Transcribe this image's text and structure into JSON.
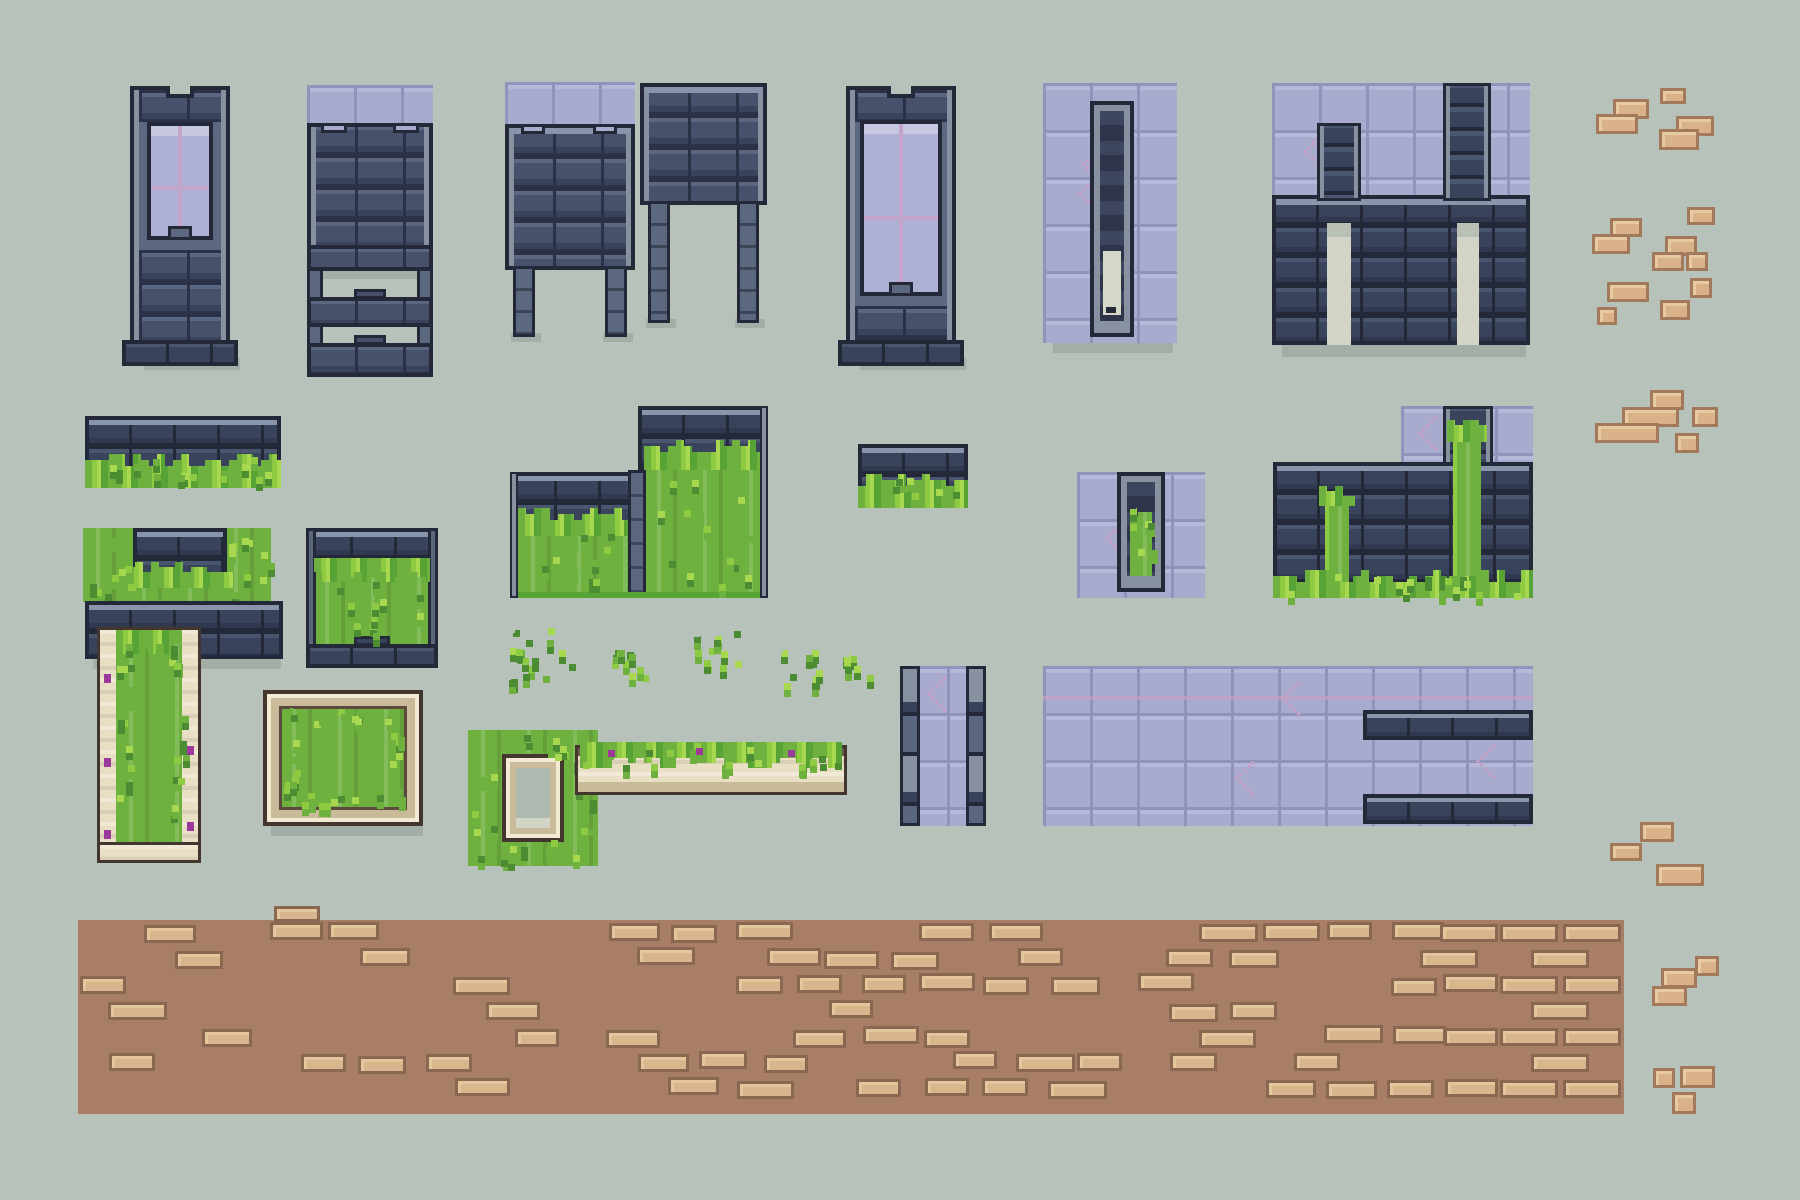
{
  "palette": {
    "bg": "#b7c3ba",
    "shadow": "#a3afa6",
    "outline": "#232938",
    "mortar": "#2b3247",
    "stoneFace": "#47516c",
    "stoneHi": "#5b6681",
    "stoneLow": "#3a435c",
    "trim": "#8995ab",
    "railLight": "#87919f",
    "purple": "#a9abce",
    "purpleLine": "#9093ba",
    "purpleHi": "#b6b8d9",
    "crack": "#c79ec3",
    "glass": "#aeb1d4",
    "glassHi": "#c5c8e6",
    "mullion": "#c2a5c8",
    "grass": "#6fb13f",
    "grassHi": "#a8d84f",
    "grassMid": "#8fcb42",
    "grassDark": "#4c8c33",
    "grassLine": "#57a336",
    "cream": "#e9dfc4",
    "creamHi": "#f2ead2",
    "creamLow": "#c9bb9a",
    "creamEdge": "#43362f",
    "brickFace": "#d9b28a",
    "brickHi": "#e7c9a2",
    "brickLine": "#a3795b",
    "pathBase": "#a87f66",
    "pathBrick": "#d8b58c",
    "pathBrickHi": "#e5c69c",
    "pathBrickLine": "#8a6750",
    "creamHole": "#d6d8c8",
    "doorGap": "#d2d4c6",
    "flower": "#9c3a9c"
  },
  "canvas": {
    "w": 1800,
    "h": 1200
  },
  "pieces": [
    {
      "id": "tower-window",
      "kind": "tower",
      "x": 130,
      "y": 86,
      "w": 100,
      "h": 280,
      "win": [
        17,
        36,
        66,
        118
      ]
    },
    {
      "id": "gate-frame",
      "kind": "gate",
      "x": 307,
      "y": 85,
      "w": 126,
      "h": 292
    },
    {
      "id": "wall-on-legs-left",
      "kind": "wallLegs",
      "x": 505,
      "y": 82,
      "w": 130,
      "h": 255,
      "purpleTop": true,
      "wallTop": 42,
      "wallH": 146,
      "legH": 67
    },
    {
      "id": "wall-on-legs-right",
      "kind": "wallLegs",
      "x": 640,
      "y": 83,
      "w": 127,
      "h": 240,
      "purpleTop": false,
      "wallTop": 0,
      "wallH": 122,
      "legH": 118
    },
    {
      "id": "tower-window-wide",
      "kind": "tower",
      "x": 846,
      "y": 86,
      "w": 110,
      "h": 280,
      "win": [
        14,
        34,
        82,
        176
      ]
    },
    {
      "id": "arrow-slit-panel",
      "kind": "slot",
      "x": 1043,
      "y": 83,
      "w": 134,
      "h": 260,
      "grass": false,
      "slot": [
        47,
        18,
        44,
        236
      ]
    },
    {
      "id": "purple-wall-chimneys",
      "kind": "purpleWall",
      "x": 1272,
      "y": 83,
      "w": 258,
      "h": 262
    },
    {
      "id": "wall-grass-strip",
      "kind": "grassStrip",
      "x": 85,
      "y": 416,
      "w": 196,
      "h": 72
    },
    {
      "id": "wall-grass-block",
      "kind": "grassStrip",
      "x": 858,
      "y": 444,
      "w": 110,
      "h": 64
    },
    {
      "id": "grass-square-wall",
      "kind": "grassSquare",
      "x": 83,
      "y": 528,
      "w": 188,
      "h": 74
    },
    {
      "id": "grass-frame",
      "kind": "grassFrame",
      "x": 306,
      "y": 528,
      "w": 132,
      "h": 140
    },
    {
      "id": "overgrown-steps",
      "kind": "steps",
      "x": 510,
      "y": 406,
      "w": 258,
      "h": 192
    },
    {
      "id": "overgrown-wall",
      "kind": "overgrown",
      "x": 1273,
      "y": 406,
      "w": 260,
      "h": 192
    },
    {
      "id": "slit-panel-grass",
      "kind": "slot",
      "x": 1077,
      "y": 472,
      "w": 128,
      "h": 126,
      "grass": true,
      "slot": [
        40,
        0,
        48,
        120
      ]
    },
    {
      "id": "stone-slab",
      "kind": "slab",
      "x": 85,
      "y": 601,
      "w": 198,
      "h": 58
    },
    {
      "id": "garden-lane",
      "kind": "lane",
      "x": 100,
      "y": 630,
      "w": 98,
      "h": 230
    },
    {
      "id": "box-planter",
      "kind": "boxPlanter",
      "x": 263,
      "y": 690,
      "w": 160,
      "h": 136
    },
    {
      "id": "window-planter",
      "kind": "windowPlanter",
      "x": 468,
      "y": 730,
      "w": 130,
      "h": 136
    },
    {
      "id": "flower-bed",
      "kind": "flowerBed",
      "x": 578,
      "y": 748,
      "w": 266,
      "h": 44
    },
    {
      "id": "purple-corridor",
      "kind": "corridor",
      "x": 900,
      "y": 666,
      "w": 86,
      "h": 160
    },
    {
      "id": "purple-floor",
      "kind": "floor",
      "x": 1043,
      "y": 666,
      "w": 490,
      "h": 160,
      "bars": [
        [
          320,
          44,
          170,
          30
        ],
        [
          320,
          128,
          170,
          30
        ]
      ]
    },
    {
      "id": "brick-path",
      "kind": "path",
      "x": 78,
      "y": 920,
      "w": 1546,
      "h": 194,
      "zones": [
        [
          0,
          530,
          0.32
        ],
        [
          530,
          1060,
          0.5
        ],
        [
          1060,
          1422,
          0.62
        ],
        [
          1422,
          1546,
          1.0
        ]
      ],
      "topBrick": [
        196,
        -14,
        46,
        16
      ]
    },
    {
      "id": "foliage-1",
      "kind": "foliage",
      "x": 508,
      "y": 626,
      "w": 72,
      "h": 70,
      "n": 16
    },
    {
      "id": "foliage-2",
      "kind": "foliage",
      "x": 608,
      "y": 648,
      "w": 58,
      "h": 46,
      "n": 10
    },
    {
      "id": "foliage-3",
      "kind": "foliage",
      "x": 693,
      "y": 630,
      "w": 50,
      "h": 60,
      "n": 11
    },
    {
      "id": "foliage-4",
      "kind": "foliage",
      "x": 776,
      "y": 646,
      "w": 48,
      "h": 52,
      "n": 9
    },
    {
      "id": "foliage-5",
      "kind": "foliage",
      "x": 843,
      "y": 650,
      "w": 34,
      "h": 44,
      "n": 7
    },
    {
      "id": "loose-bricks",
      "kind": "bricks",
      "list": [
        [
          1660,
          88,
          26,
          16
        ],
        [
          1613,
          99,
          36,
          20
        ],
        [
          1596,
          114,
          42,
          20
        ],
        [
          1676,
          116,
          38,
          20
        ],
        [
          1659,
          129,
          40,
          21
        ],
        [
          1687,
          207,
          28,
          18
        ],
        [
          1610,
          218,
          32,
          19
        ],
        [
          1592,
          234,
          38,
          20
        ],
        [
          1665,
          236,
          32,
          20
        ],
        [
          1652,
          252,
          32,
          19
        ],
        [
          1686,
          252,
          22,
          19
        ],
        [
          1607,
          282,
          42,
          20
        ],
        [
          1690,
          278,
          22,
          20
        ],
        [
          1660,
          300,
          30,
          20
        ],
        [
          1597,
          307,
          20,
          18
        ],
        [
          1650,
          390,
          34,
          20
        ],
        [
          1622,
          407,
          57,
          20
        ],
        [
          1692,
          407,
          26,
          20
        ],
        [
          1595,
          423,
          64,
          20
        ],
        [
          1675,
          433,
          24,
          20
        ],
        [
          1640,
          822,
          34,
          20
        ],
        [
          1610,
          843,
          32,
          18
        ],
        [
          1656,
          864,
          48,
          22
        ],
        [
          1695,
          956,
          24,
          20
        ],
        [
          1661,
          968,
          36,
          20
        ],
        [
          1652,
          986,
          35,
          20
        ],
        [
          1680,
          1066,
          35,
          22
        ],
        [
          1653,
          1068,
          22,
          20
        ],
        [
          1672,
          1092,
          24,
          22
        ]
      ]
    }
  ]
}
